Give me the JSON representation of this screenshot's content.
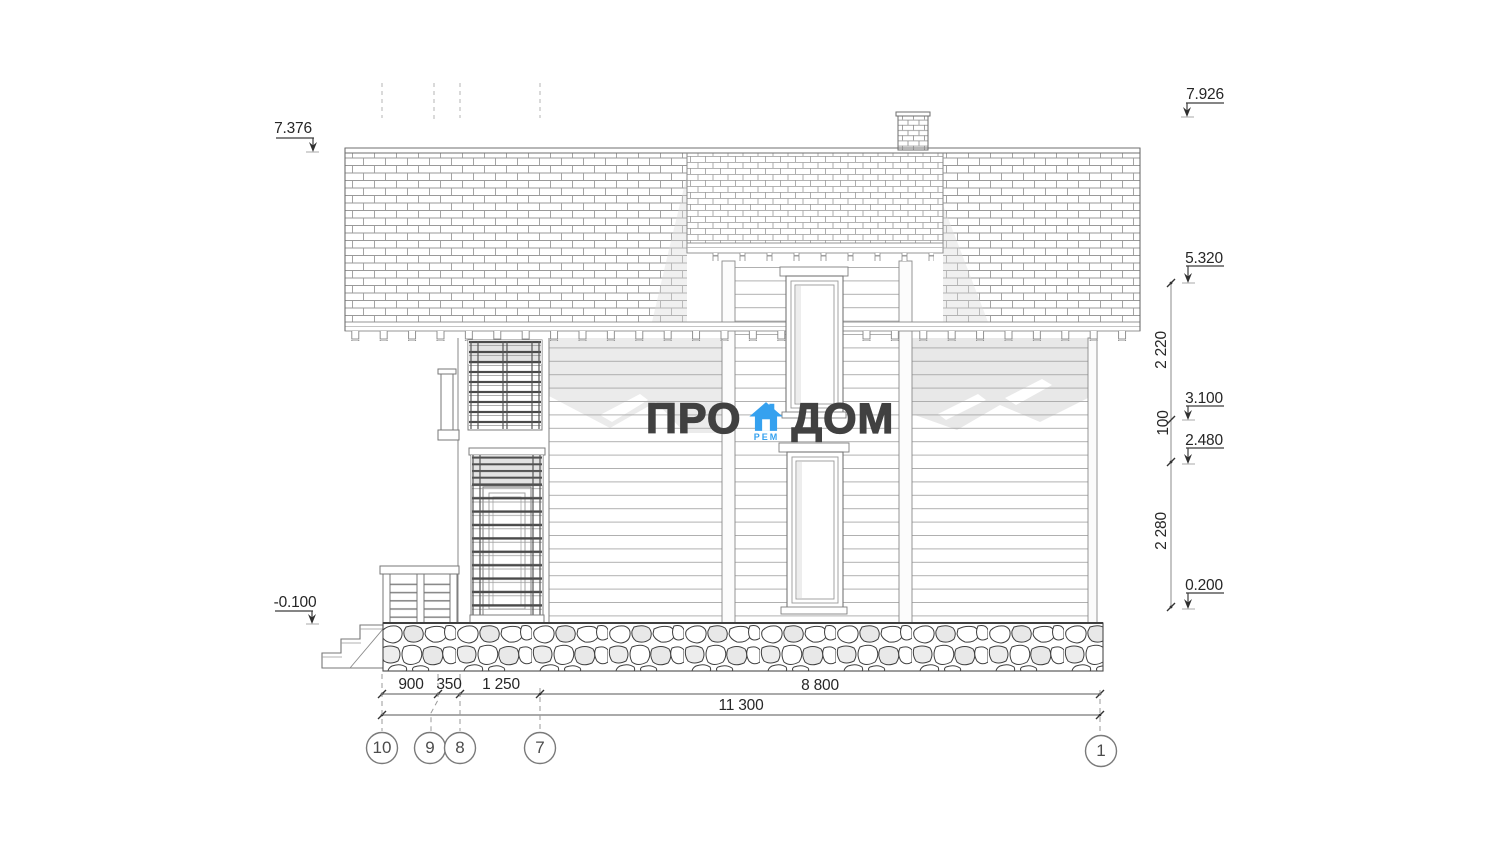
{
  "logo": {
    "pro": "ПРО",
    "dom": "ДОМ",
    "rem": "РЕМ",
    "blue": "#35a1ef",
    "text_color": "#414141"
  },
  "levels": {
    "l7376": "7.376",
    "l7926": "7.926",
    "l5320": "5.320",
    "l3100": "3.100",
    "l2480": "2.480",
    "l0200": "0.200",
    "lm0100": "-0.100"
  },
  "vertical_dims": {
    "upper": "2 220",
    "middle": "100",
    "lower": "2 280"
  },
  "bottom_dims": {
    "d900": "900",
    "d350": "350",
    "d1250": "1 250",
    "d8800": "8 800",
    "total": "11 300"
  },
  "axes": {
    "a10": "10",
    "a9": "9",
    "a8": "8",
    "a7": "7",
    "a1": "1"
  }
}
